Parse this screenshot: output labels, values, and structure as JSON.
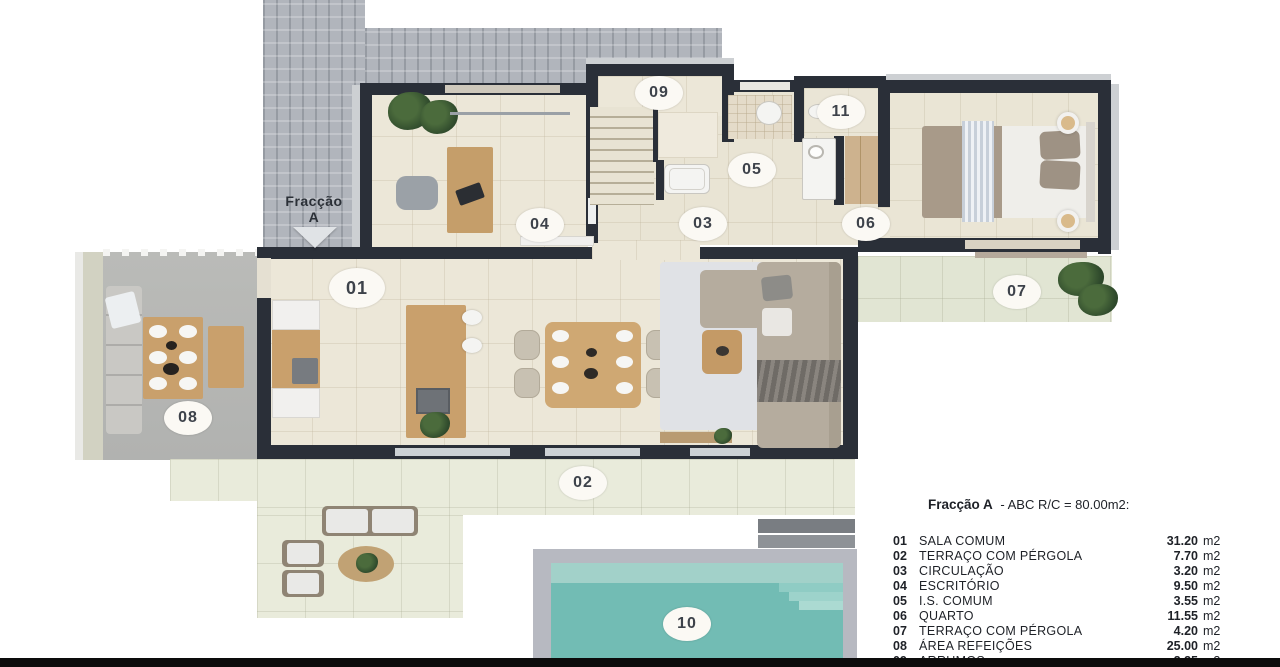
{
  "plan": {
    "fraction_marker": {
      "line1": "Fracção",
      "line2": "A"
    },
    "labels": [
      {
        "text": "01"
      },
      {
        "text": "02"
      },
      {
        "text": "03"
      },
      {
        "text": "04"
      },
      {
        "text": "05"
      },
      {
        "text": "06"
      },
      {
        "text": "07"
      },
      {
        "text": "08"
      },
      {
        "text": "09"
      },
      {
        "text": "10"
      },
      {
        "text": "11"
      }
    ]
  },
  "legend": {
    "title_name": "Fracção A",
    "title_rest": "- ABC R/C = 80.00m2:",
    "rows": [
      {
        "num": "01",
        "name": "SALA COMUM",
        "area": "31.20",
        "unit": "m2"
      },
      {
        "num": "02",
        "name": "TERRAÇO COM PÉRGOLA",
        "area": "7.70",
        "unit": "m2"
      },
      {
        "num": "03",
        "name": "CIRCULAÇÃO",
        "area": "3.20",
        "unit": "m2"
      },
      {
        "num": "04",
        "name": "ESCRITÓRIO",
        "area": "9.50",
        "unit": "m2"
      },
      {
        "num": "05",
        "name": "I.S. COMUM",
        "area": "3.55",
        "unit": "m2"
      },
      {
        "num": "06",
        "name": "QUARTO",
        "area": "11.55",
        "unit": "m2"
      },
      {
        "num": "07",
        "name": "TERRAÇO COM PÉRGOLA",
        "area": "4.20",
        "unit": "m2"
      },
      {
        "num": "08",
        "name": "ÁREA REFEIÇÕES",
        "area": "25.00",
        "unit": "m2"
      },
      {
        "num": "09",
        "name": "ARRUMOS",
        "area": "2.35",
        "unit": "m2"
      }
    ]
  },
  "colors": {
    "wall": "#2a2f38",
    "pool_water": "#72bcb4",
    "interior_floor": "#ece7d8",
    "terrace_floor": "#e9ebdb",
    "brick_paving": "#b1b5bc",
    "concrete_floor": "#b6b7b5"
  }
}
